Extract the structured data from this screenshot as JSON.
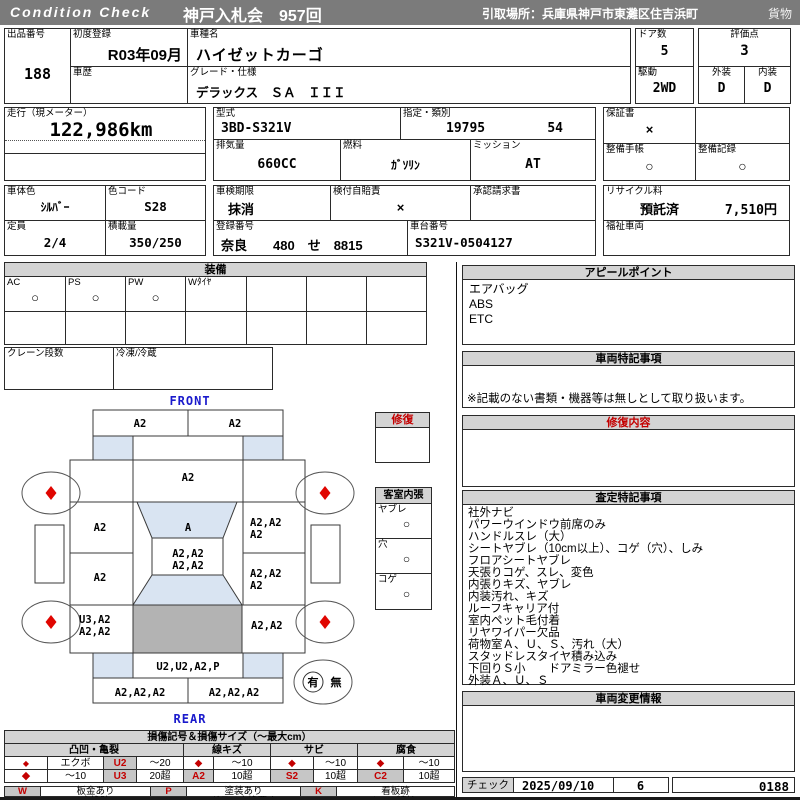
{
  "header": {
    "brand": "Condition  Check",
    "auction_title": "神戸入札会　957回",
    "pickup": "引取場所：兵庫県神戸市東灘区住吉浜町",
    "category": "貨物"
  },
  "info": {
    "lot_label": "出品番号",
    "lot_no": "188",
    "first_reg_label": "初度登録",
    "first_reg": "R03年09月",
    "history_label": "車歴",
    "history": "",
    "model_name_label": "車種名",
    "model_name": "ハイゼットカーゴ",
    "grade_label": "グレード・仕様",
    "grade": "デラックス　ＳＡ　ＩＩＩ",
    "doors_label": "ドア数",
    "doors": "5",
    "score_label": "評価点",
    "score": "3",
    "drive_label": "駆動",
    "drive": "2WD",
    "exterior_label": "外装",
    "exterior": "D",
    "interior_label": "内装",
    "interior": "D",
    "odo_label": "走行（現メーター）",
    "odo": "122,986km",
    "model_code_label": "型式",
    "model_code": "3BD-S321V",
    "class_label": "指定・類別",
    "class_no1": "19795",
    "class_no2": "54",
    "warranty_label": "保証書",
    "warranty": "×",
    "displacement_label": "排気量",
    "displacement": "660CC",
    "fuel_label": "燃料",
    "fuel": "ｶﾞｿﾘﾝ",
    "mission_label": "ミッション",
    "mission": "AT",
    "book_label": "整備手帳",
    "book": "○",
    "record_label": "整備記録",
    "record": "○",
    "color_label": "車体色",
    "color": "ｼﾙﾊﾞｰ",
    "color_code_label": "色コード",
    "color_code": "S28",
    "inspection_label": "車検期限",
    "inspection": "抹消",
    "insurance_label": "検付自賠責",
    "insurance": "×",
    "approval_label": "承認請求書",
    "approval": "",
    "recycle_label": "リサイクル料",
    "recycle_status": "預託済",
    "recycle_fee": "7,510円",
    "capacity_label": "定員",
    "capacity": "2/4",
    "load_label": "積載量",
    "load": "350/250",
    "reg_no_label": "登録番号",
    "reg_no": "奈良　　480　せ　8815",
    "chassis_label": "車台番号",
    "chassis_no": "S321V-0504127",
    "welfare_label": "福祉車両",
    "welfare": ""
  },
  "equipment": {
    "title": "装備",
    "cols": [
      {
        "label": "AC",
        "value": "○"
      },
      {
        "label": "PS",
        "value": "○"
      },
      {
        "label": "PW",
        "value": "○"
      },
      {
        "label": "Wﾀｲﾔ",
        "value": ""
      },
      {
        "label": "",
        "value": ""
      },
      {
        "label": "",
        "value": ""
      },
      {
        "label": "",
        "value": ""
      }
    ],
    "crane_label": "クレーン段数",
    "crane": "",
    "freezer_label": "冷凍/冷蔵",
    "freezer": ""
  },
  "diagram": {
    "front_label": "FRONT",
    "rear_label": "REAR",
    "repair_box_label": "修復",
    "cabin_title": "客室内張",
    "cabin_items": [
      {
        "label": "ヤブレ",
        "value": "○"
      },
      {
        "label": "穴",
        "value": "○"
      },
      {
        "label": "コゲ",
        "value": "○"
      }
    ],
    "spare_yes": "有",
    "spare_no": "無",
    "zones": {
      "front_bumper_l": "A2",
      "front_bumper_r": "A2",
      "hood": "A2",
      "windshield": "A",
      "door_front_left": "A2",
      "door_rear_left": "A2",
      "side_right_front_1": "A2,A2",
      "side_right_front_2": "A2",
      "roof_1": "A2,A2",
      "roof_2": "A2,A2",
      "side_right_rear_1": "A2,A2",
      "side_right_rear_2": "A2",
      "quarter_left_1": "U3,A2",
      "quarter_left_2": "A2,A2",
      "quarter_right": "A2,A2",
      "rear_panel": "U2,U2,A2,P",
      "rear_bumper_l": "A2,A2,A2",
      "rear_bumper_r": "A2,A2,A2"
    }
  },
  "appeal": {
    "title": "アピールポイント",
    "items": [
      "エアバッグ",
      "ABS",
      "ETC"
    ]
  },
  "vehicle_notes": {
    "title": "車両特記事項",
    "note": "※記載のない書類・機器等は無しとして取り扱います。"
  },
  "repair": {
    "title": "修復内容",
    "body": ""
  },
  "assessment": {
    "title": "査定特記事項",
    "items": [
      "社外ナビ",
      "パワーウインドウ前席のみ",
      "ハンドルスレ（大）",
      "シートヤブレ（10cm以上）、コゲ（穴）、しみ",
      "フロアシートヤブレ",
      "天張りコゲ、スレ、変色",
      "内張りキズ、ヤブレ",
      "内装汚れ、キズ",
      "ルーフキャリア付",
      "室内ペット毛付着",
      "リヤワイパー欠品",
      "荷物室Ａ、Ｕ、Ｓ、汚れ（大）",
      "スタッドレスタイヤ積み込み",
      "下回りＳ小　　ドアミラー色褪せ",
      "外装Ａ、Ｕ、Ｓ"
    ]
  },
  "change_info": {
    "title": "車両変更情報",
    "body": ""
  },
  "check": {
    "label": "チェック",
    "date": "2025/09/10",
    "num": "6",
    "code": "0188"
  },
  "legend": {
    "title": "損傷記号＆損傷サイズ（～最大cm）",
    "groups": [
      "凸凹・亀裂",
      "線キズ",
      "サビ",
      "腐食"
    ],
    "dent_r1": {
      "name": "エクボ",
      "code": "U2",
      "size": "～20"
    },
    "dent_r2": {
      "name": "～10",
      "code": "U3",
      "size": "20超"
    },
    "scratch_r1_size": "～10",
    "scratch_r2": {
      "code": "A2",
      "size": "10超"
    },
    "rust_r1_size": "～10",
    "rust_r2": {
      "code": "S2",
      "size": "10超"
    },
    "corr_r1_size": "～10",
    "corr_r2": {
      "code": "C2",
      "size": "10超"
    },
    "diamond": "◆",
    "marks": [
      {
        "code": "W",
        "label": "板金あり"
      },
      {
        "code": "P",
        "label": "塗装あり"
      },
      {
        "code": "K",
        "label": "看板跡"
      },
      {
        "code": "X",
        "label": "交換跡"
      },
      {
        "code": "G",
        "label": "ガラス交換要す"
      },
      {
        "code": "L",
        "label": "レンズ割れ"
      }
    ]
  }
}
